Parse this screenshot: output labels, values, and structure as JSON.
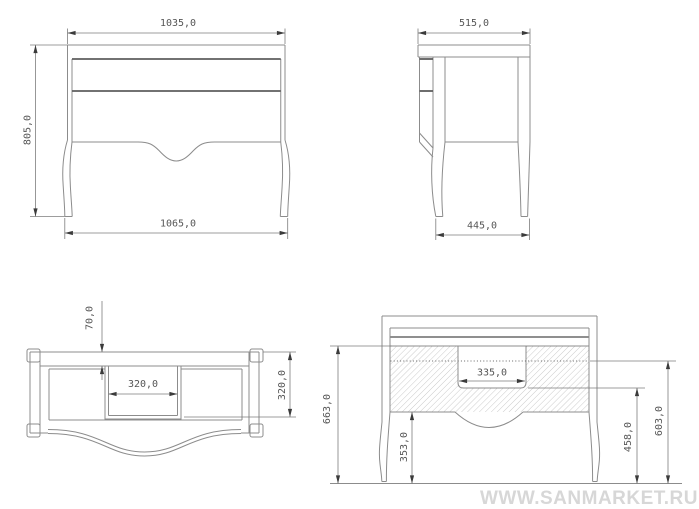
{
  "page": {
    "background": "#ffffff"
  },
  "watermark": {
    "text": "WWW.SANMARKET.RU",
    "color": "#d5d5d5"
  },
  "drawing": {
    "line_color": "#8c8c8c",
    "dimension_color": "#7d7d7d",
    "hatch_color": "#bfbfbf",
    "views": {
      "front_view": {
        "dim_top_width": "1035,0",
        "dim_height": "805,0",
        "dim_feet_width": "1065,0"
      },
      "side_view": {
        "dim_top_depth": "515,0",
        "dim_feet_depth": "445,0"
      },
      "plan_view": {
        "dim_back_offset": "70,0",
        "dim_cutout_width": "320,0",
        "dim_cutout_depth": "320,0"
      },
      "section_view": {
        "dim_cutout_width": "335,0",
        "dim_apron_to_floor": "353,0",
        "dim_cutout_bottom_to_floor": "458,0",
        "dim_line_to_floor": "603,0",
        "dim_top_to_floor": "663,0"
      }
    }
  }
}
